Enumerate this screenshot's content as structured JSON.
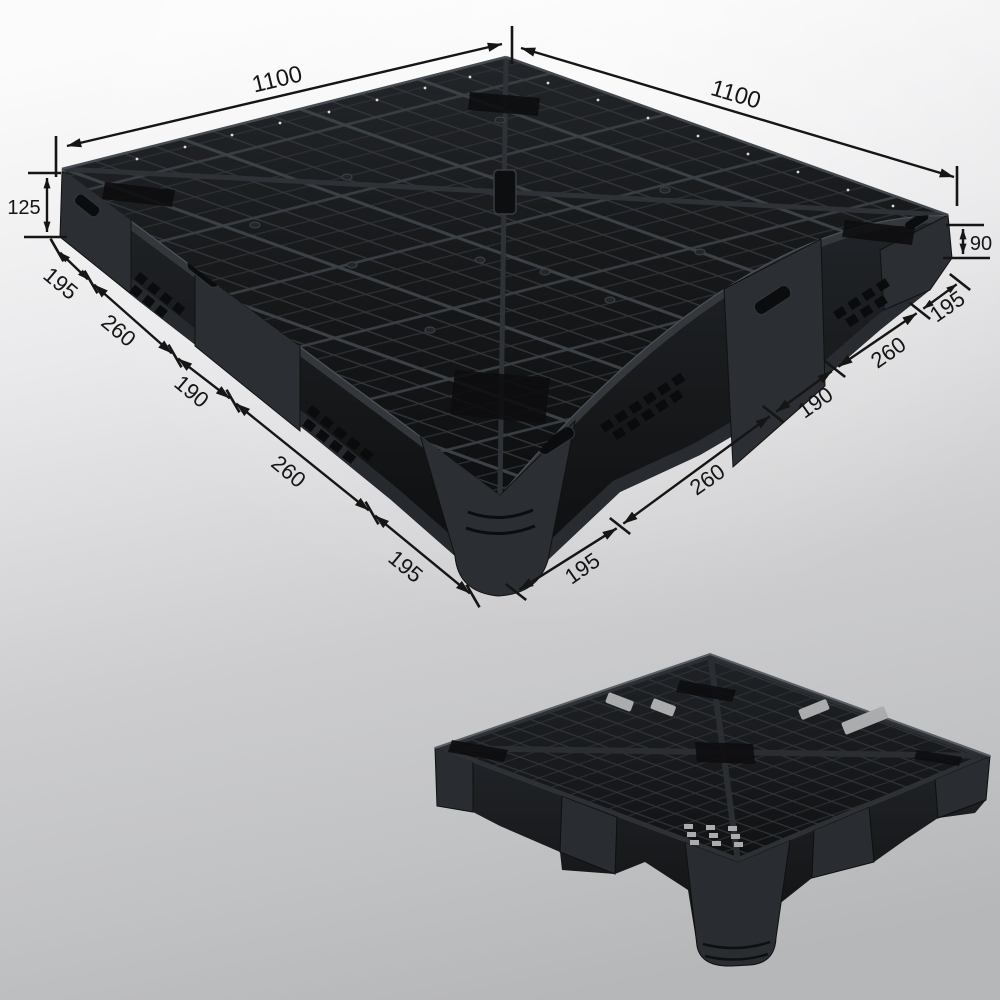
{
  "figure": {
    "subject": "Black plastic pallet product photo with dimension callouts",
    "main_view": "perspective top view of pallet",
    "secondary_view": "underside view of pallet",
    "colors": {
      "background_top": "#fafafa",
      "background_bottom": "#b6b7b9",
      "pallet_black": "#17191b",
      "annotation_black": "#151515"
    }
  },
  "dims": {
    "top_left_length": "1100",
    "top_right_length": "1100",
    "left_height": "125",
    "right_height": "90",
    "left_segments": [
      "195",
      "260",
      "190",
      "260",
      "195"
    ],
    "right_segments": [
      "195",
      "260",
      "190",
      "260",
      "195"
    ]
  }
}
